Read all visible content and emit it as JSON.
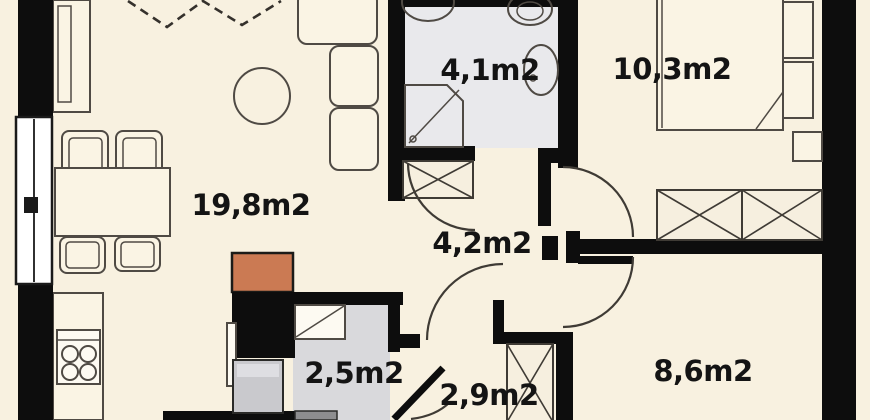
{
  "plan_title": "apartment-floor-plan",
  "rooms": {
    "living_kitchen": {
      "label": "19,8m2"
    },
    "bathroom": {
      "label": "4,1m2"
    },
    "bedroom": {
      "label": "10,3m2"
    },
    "hallway": {
      "label": "4,2m2"
    },
    "storage": {
      "label": "2,5m2"
    },
    "corridor": {
      "label": "2,9m2"
    },
    "small_room": {
      "label": "8,6m2"
    }
  },
  "colors": {
    "floor": "#f8f1e0",
    "wall": "#0d0d0d",
    "bathfloor": "#e9e9ec",
    "storagefloor": "#d9d9dc",
    "furnline": "#4f4a44",
    "accentorange": "#cb7a53",
    "appliancegray": "#c9c9cd",
    "washergray": "#8d8d8f",
    "labelink": "#141414"
  }
}
